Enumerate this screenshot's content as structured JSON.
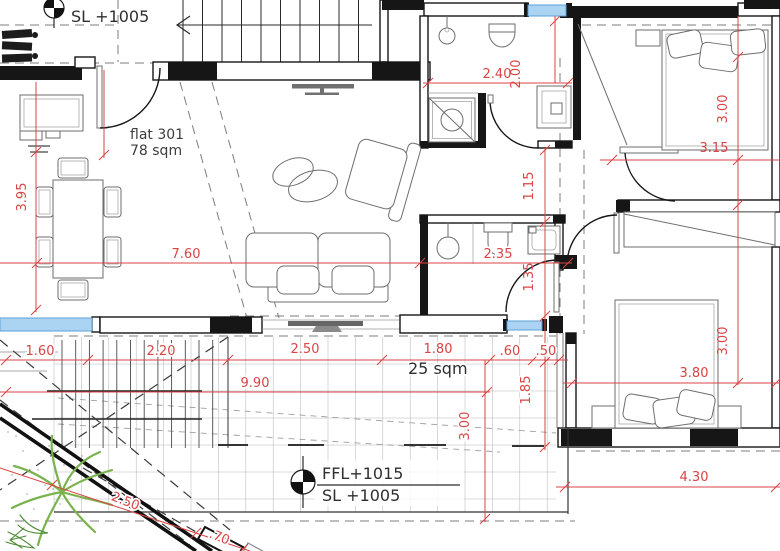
{
  "drawing": {
    "flat_label": "flat 301",
    "flat_area": "78 sqm",
    "terrace_area": "25 sqm",
    "upper_landing_level": "SL +1005",
    "terrace_ffl": "FFL+1015",
    "terrace_sl": "SL +1005"
  },
  "dimensions": {
    "bath_width_top": "2.40",
    "entry_depth": "2.00",
    "living_depth": "3.95",
    "living_width": "7.60",
    "bath_width_mid": "2.35",
    "hall_segment_a": "1.15",
    "hall_segment_b": "1.35",
    "bedroom1_depth": "3.00",
    "bedroom1_width": "3.15",
    "bedroom2_depth": "3.00",
    "bedroom2_width": "3.80",
    "bedroom2_overall": "4.30",
    "terrace_step": "1.85",
    "terrace_seg1": "1.60",
    "terrace_seg2": "2.20",
    "terrace_seg3": "2.50",
    "terrace_seg4": "1.80",
    "terrace_seg5": ".60",
    "terrace_seg6": ".50",
    "terrace_width": "9.90",
    "terrace_depth": "3.00",
    "stair_run": "2.50",
    "stair_end": ".70"
  },
  "colors": {
    "dimension_red": "#d94444",
    "window_blue_fill": "#abd4f2",
    "window_blue_stroke": "#5e9fd4",
    "plant_green": "#7ab34d",
    "wall_black": "#161616",
    "furniture_gray": "#6e6e6e"
  }
}
